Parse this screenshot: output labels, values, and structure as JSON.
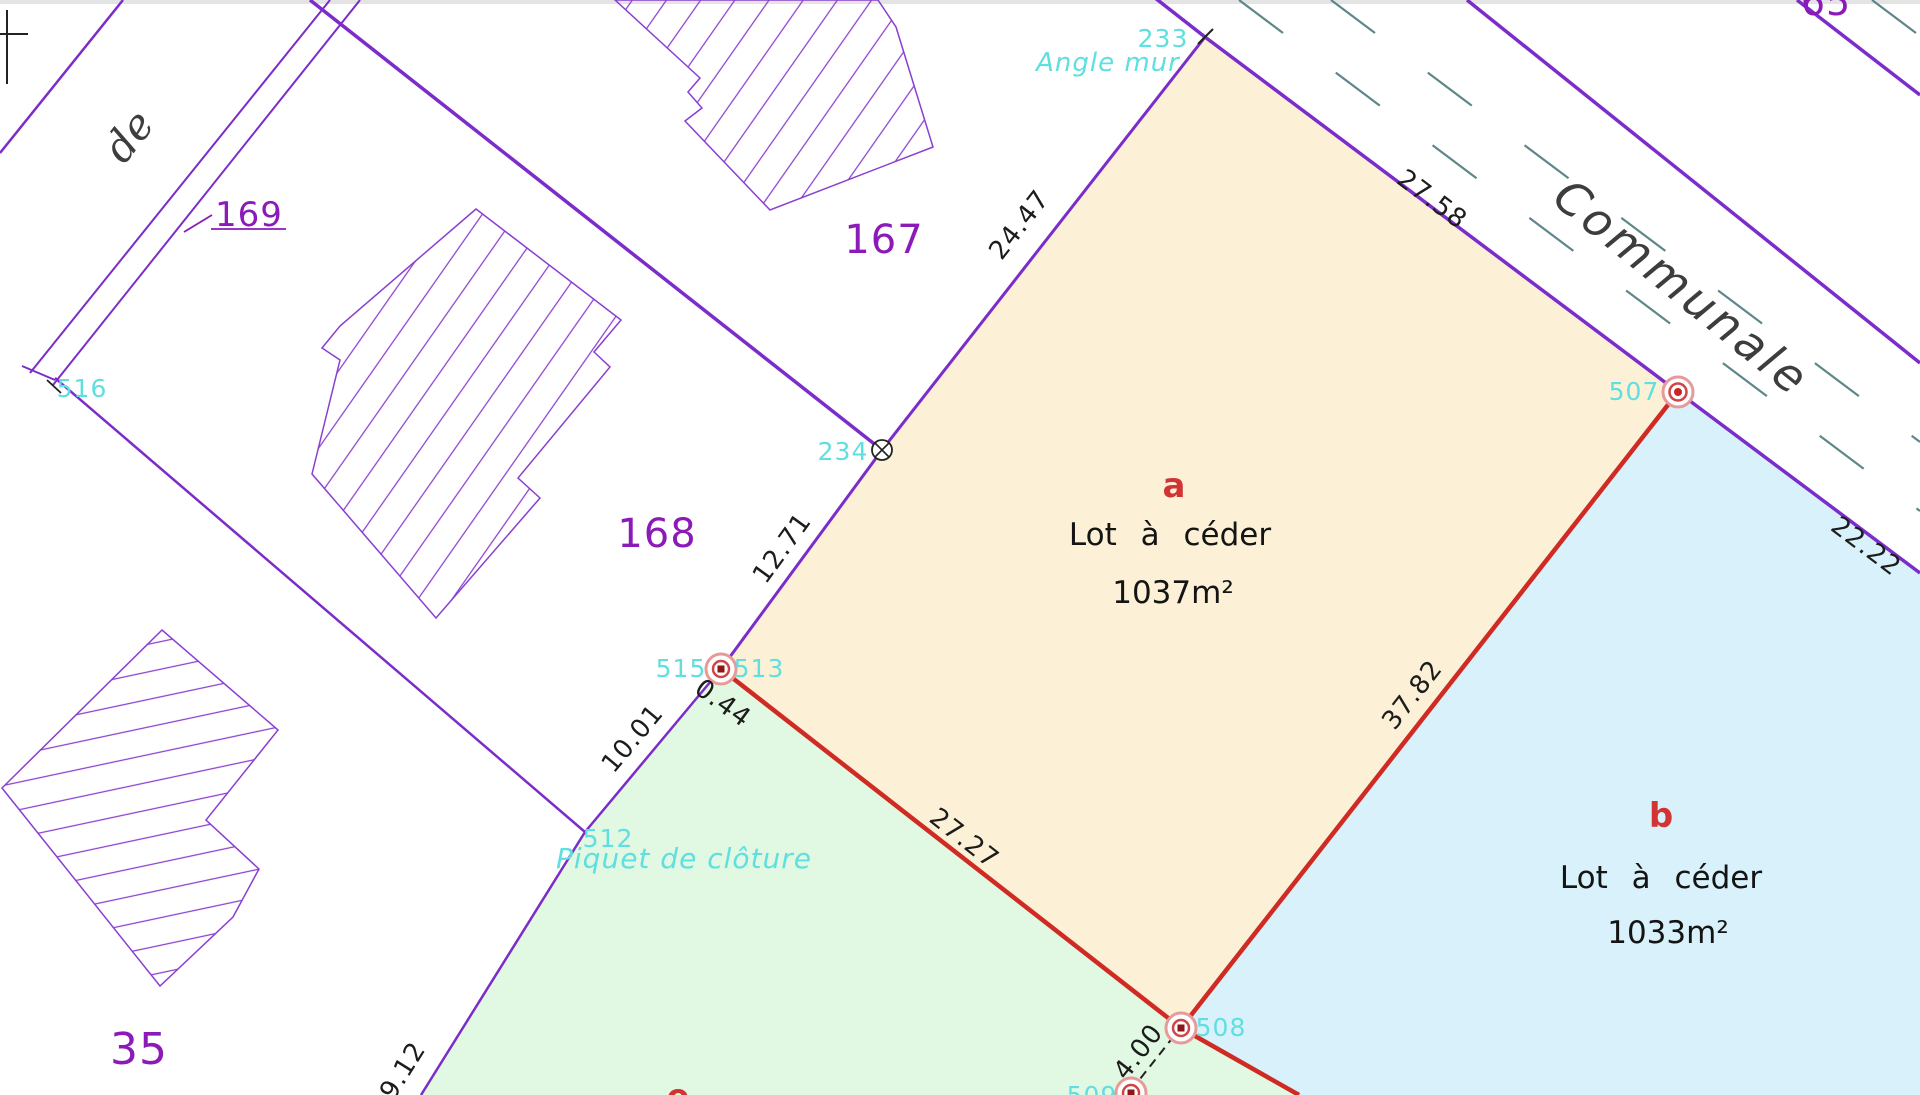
{
  "palette": {
    "parcel_line": "#7b2cc9",
    "parcel_text": "#8b1ab8",
    "point_label_cyan": "#5fdfdf",
    "boundary_red": "#cf2b24",
    "lot_letter_red": "#d23434",
    "dimension_text": "#1c1c1c",
    "road_dash_teal": "#5e8789",
    "lot_a_fill": "#fcf1d7",
    "lot_b_fill": "#d8f1fa",
    "lot_e_fill": "#e1f8e3"
  },
  "parcels": {
    "p169": "169",
    "p167": "167",
    "p168": "168",
    "p35": "35",
    "p65": "65"
  },
  "lots": {
    "a": {
      "letter": "a",
      "label": "Lot à céder",
      "area": "1037m²"
    },
    "b": {
      "letter": "b",
      "label": "Lot à céder",
      "area": "1033m²"
    },
    "e": {
      "letter": "e"
    }
  },
  "roads": {
    "de": "de",
    "communale": "Communale"
  },
  "points": {
    "p233": "233",
    "p234": "234",
    "p507": "507",
    "p508": "508",
    "p509": "509",
    "p512": "512",
    "p513": "513",
    "p515": "515",
    "p516": "516"
  },
  "annotations": {
    "angle_mur": "Angle mur",
    "piquet_cloture": "Piquet de clôture"
  },
  "dimensions": {
    "d24_47": "24.47",
    "d27_58": "27.58",
    "d22_22": "22.22",
    "d37_82": "37.82",
    "d27_27": "27.27",
    "d12_71": "12.71",
    "d10_01": "10.01",
    "d0_44": "0.44",
    "d9_12": "9.12",
    "d4_00": "4.00"
  }
}
